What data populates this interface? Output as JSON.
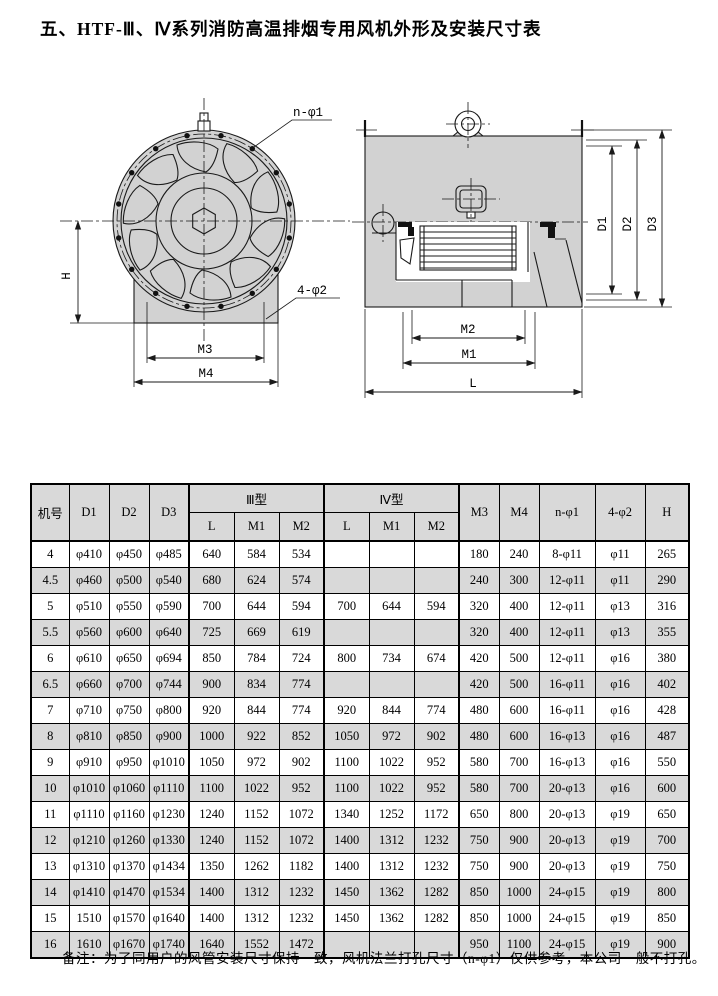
{
  "title": "五、HTF-Ⅲ、Ⅳ系列消防高温排烟专用风机外形及安装尺寸表",
  "note": "备注：为了同用户的风管安装尺寸保持一致，风机法兰打孔尺寸（n-φ1）仅供参考，本公司一般不打孔。",
  "colors": {
    "page_bg": "#ffffff",
    "table_stripe": "#d9d9d9",
    "drawing_fill": "#d2d2d2",
    "line": "#1a1a1a"
  },
  "front_view": {
    "labels": {
      "bolt_circle": "n-φ1",
      "base_holes": "4-φ2",
      "height": "H",
      "m3": "M3",
      "m4": "M4"
    }
  },
  "side_view": {
    "labels": {
      "d1": "D1",
      "d2": "D2",
      "d3": "D3",
      "m1": "M1",
      "m2": "M2",
      "l": "L"
    }
  },
  "table": {
    "headers": {
      "machine": "机号",
      "d1": "D1",
      "d2": "D2",
      "d3": "D3",
      "type3": "Ⅲ型",
      "type4": "Ⅳ型",
      "l3": "L",
      "m1_3": "M1",
      "m2_3": "M2",
      "l4": "L",
      "m1_4": "M1",
      "m2_4": "M2",
      "m3": "M3",
      "m4": "M4",
      "n_phi1": "n-φ1",
      "four_phi2": "4-φ2",
      "h": "H"
    },
    "rows": [
      [
        "4",
        "φ410",
        "φ450",
        "φ485",
        "640",
        "584",
        "534",
        "",
        "",
        "",
        "180",
        "240",
        "8-φ11",
        "φ11",
        "265"
      ],
      [
        "4.5",
        "φ460",
        "φ500",
        "φ540",
        "680",
        "624",
        "574",
        "",
        "",
        "",
        "240",
        "300",
        "12-φ11",
        "φ11",
        "290"
      ],
      [
        "5",
        "φ510",
        "φ550",
        "φ590",
        "700",
        "644",
        "594",
        "700",
        "644",
        "594",
        "320",
        "400",
        "12-φ11",
        "φ13",
        "316"
      ],
      [
        "5.5",
        "φ560",
        "φ600",
        "φ640",
        "725",
        "669",
        "619",
        "",
        "",
        "",
        "320",
        "400",
        "12-φ11",
        "φ13",
        "355"
      ],
      [
        "6",
        "φ610",
        "φ650",
        "φ694",
        "850",
        "784",
        "724",
        "800",
        "734",
        "674",
        "420",
        "500",
        "12-φ11",
        "φ16",
        "380"
      ],
      [
        "6.5",
        "φ660",
        "φ700",
        "φ744",
        "900",
        "834",
        "774",
        "",
        "",
        "",
        "420",
        "500",
        "16-φ11",
        "φ16",
        "402"
      ],
      [
        "7",
        "φ710",
        "φ750",
        "φ800",
        "920",
        "844",
        "774",
        "920",
        "844",
        "774",
        "480",
        "600",
        "16-φ11",
        "φ16",
        "428"
      ],
      [
        "8",
        "φ810",
        "φ850",
        "φ900",
        "1000",
        "922",
        "852",
        "1050",
        "972",
        "902",
        "480",
        "600",
        "16-φ13",
        "φ16",
        "487"
      ],
      [
        "9",
        "φ910",
        "φ950",
        "φ1010",
        "1050",
        "972",
        "902",
        "1100",
        "1022",
        "952",
        "580",
        "700",
        "16-φ13",
        "φ16",
        "550"
      ],
      [
        "10",
        "φ1010",
        "φ1060",
        "φ1110",
        "1100",
        "1022",
        "952",
        "1100",
        "1022",
        "952",
        "580",
        "700",
        "20-φ13",
        "φ16",
        "600"
      ],
      [
        "11",
        "φ1110",
        "φ1160",
        "φ1230",
        "1240",
        "1152",
        "1072",
        "1340",
        "1252",
        "1172",
        "650",
        "800",
        "20-φ13",
        "φ19",
        "650"
      ],
      [
        "12",
        "φ1210",
        "φ1260",
        "φ1330",
        "1240",
        "1152",
        "1072",
        "1400",
        "1312",
        "1232",
        "750",
        "900",
        "20-φ13",
        "φ19",
        "700"
      ],
      [
        "13",
        "φ1310",
        "φ1370",
        "φ1434",
        "1350",
        "1262",
        "1182",
        "1400",
        "1312",
        "1232",
        "750",
        "900",
        "20-φ13",
        "φ19",
        "750"
      ],
      [
        "14",
        "φ1410",
        "φ1470",
        "φ1534",
        "1400",
        "1312",
        "1232",
        "1450",
        "1362",
        "1282",
        "850",
        "1000",
        "24-φ15",
        "φ19",
        "800"
      ],
      [
        "15",
        "1510",
        "φ1570",
        "φ1640",
        "1400",
        "1312",
        "1232",
        "1450",
        "1362",
        "1282",
        "850",
        "1000",
        "24-φ15",
        "φ19",
        "850"
      ],
      [
        "16",
        "1610",
        "φ1670",
        "φ1740",
        "1640",
        "1552",
        "1472",
        "",
        "",
        "",
        "950",
        "1100",
        "24-φ15",
        "φ19",
        "900"
      ]
    ]
  }
}
